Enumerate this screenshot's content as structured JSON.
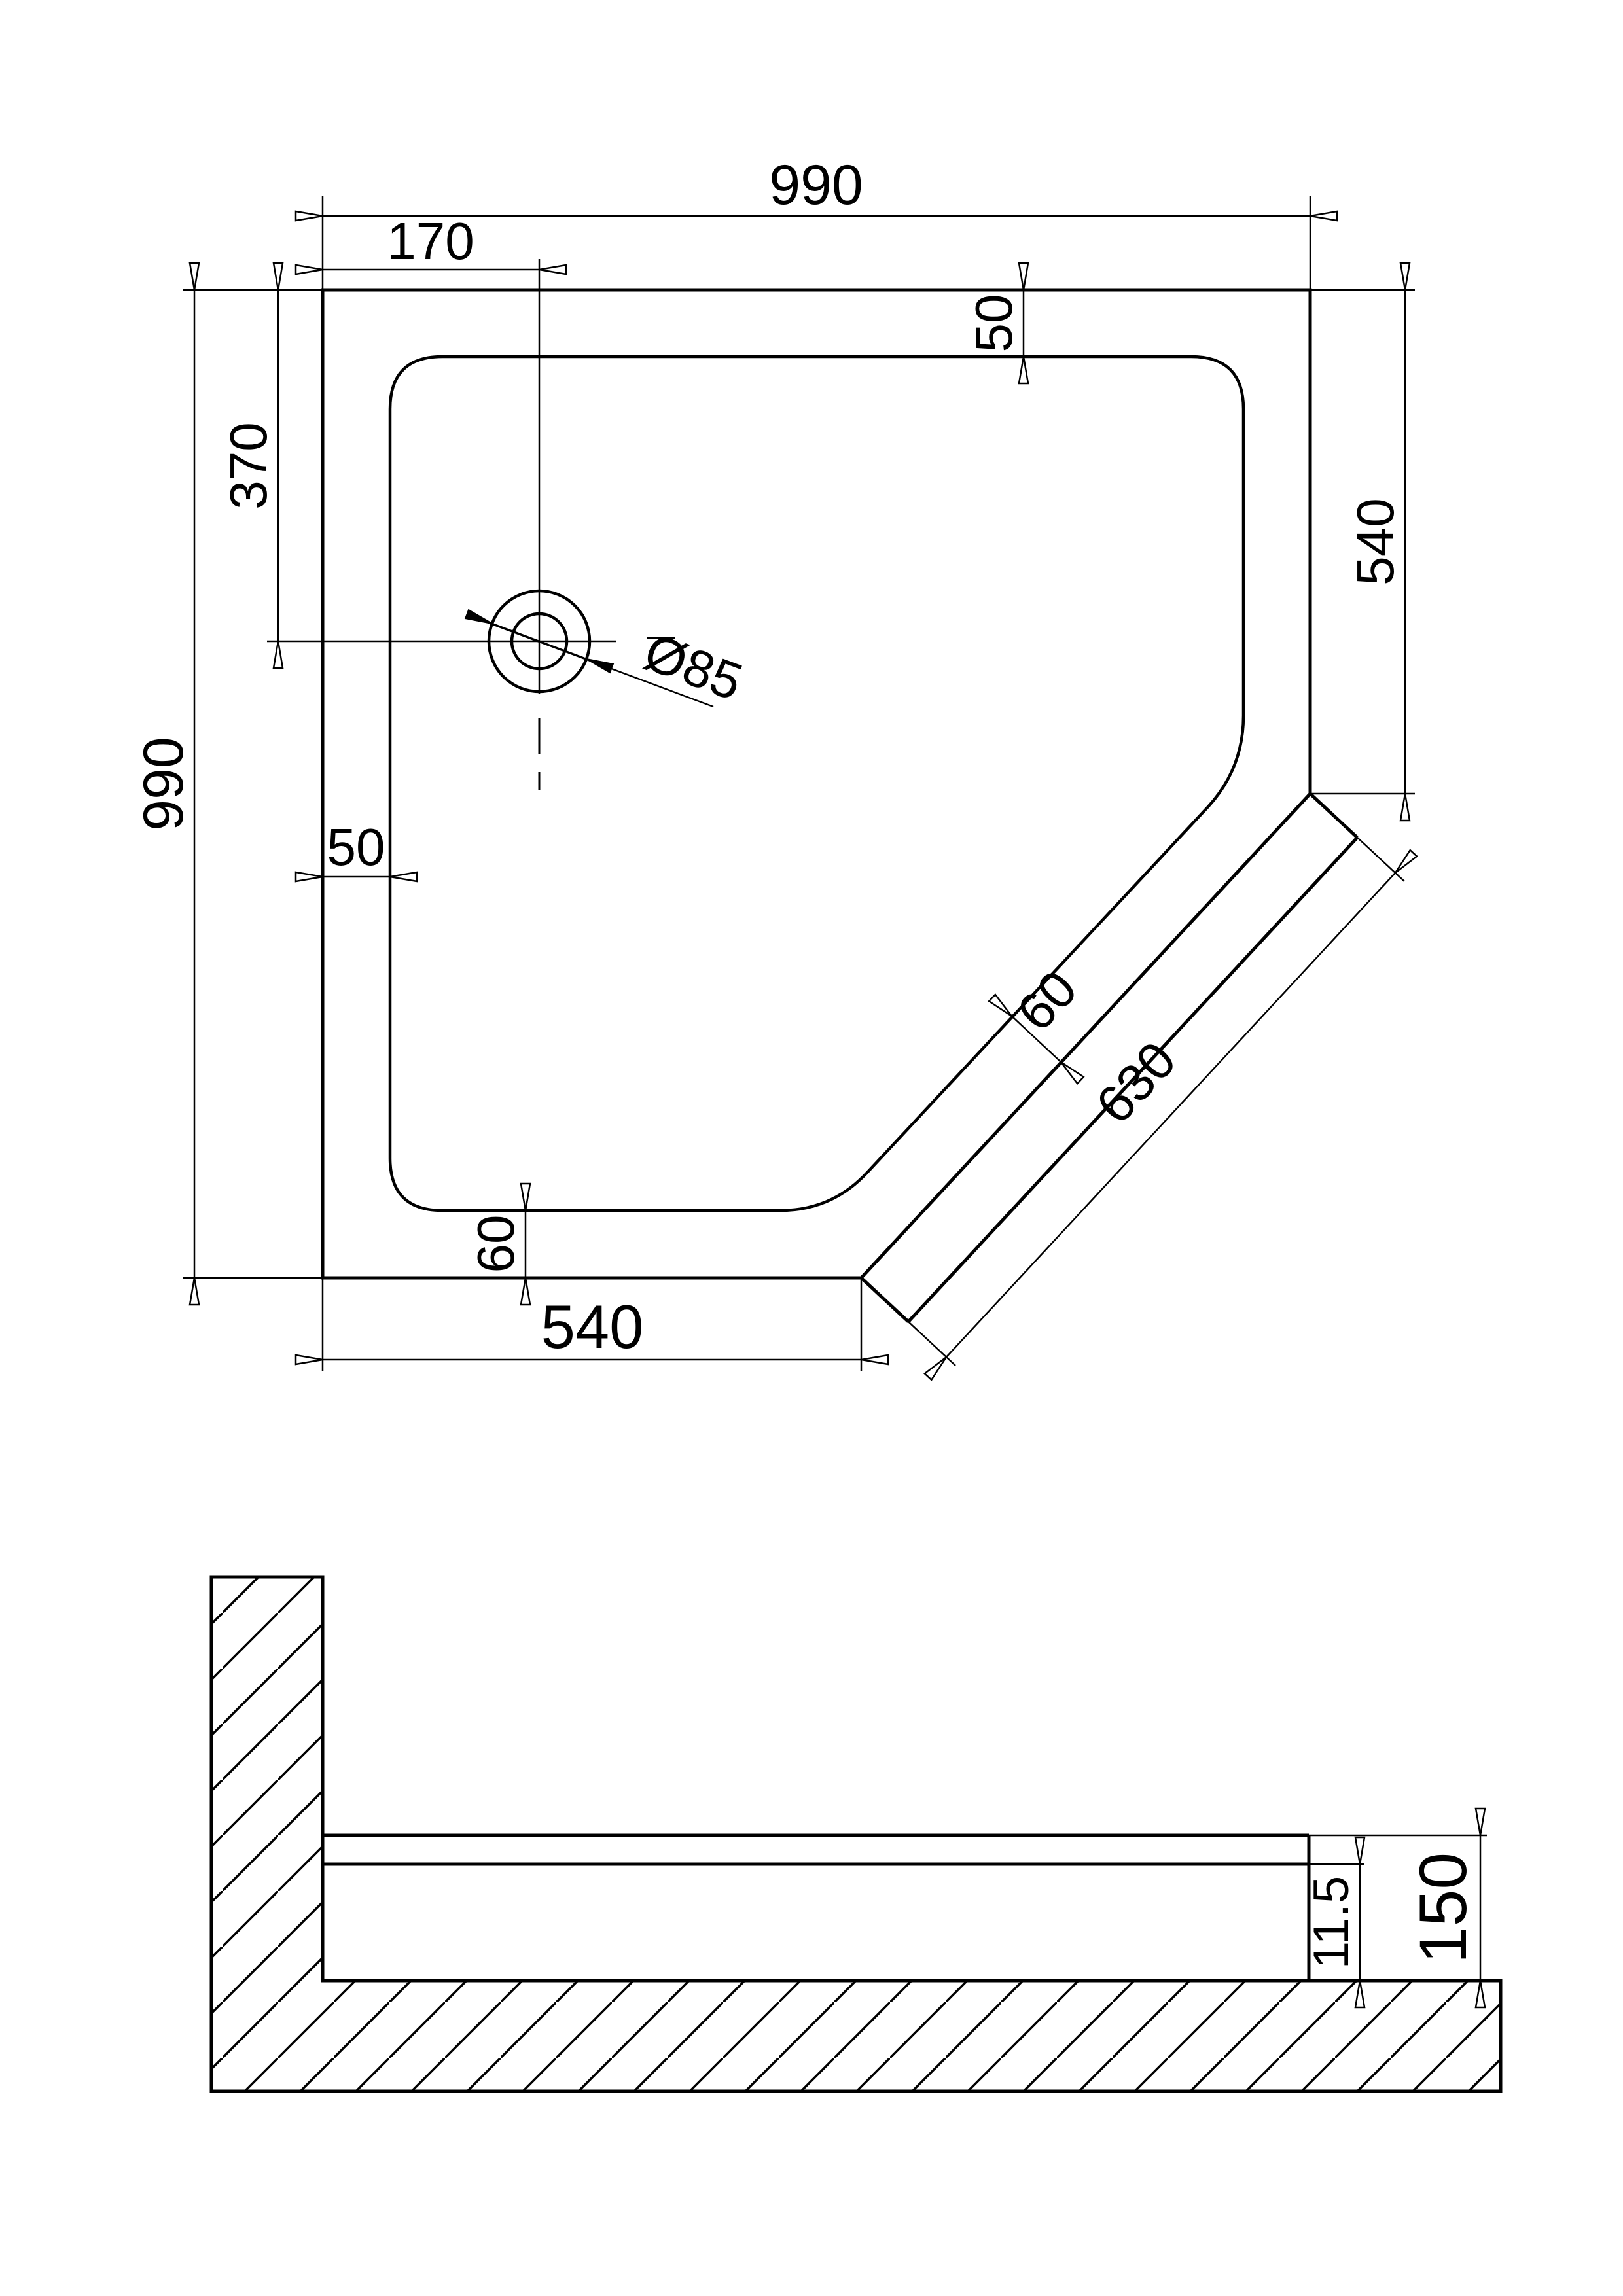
{
  "title": "Corner shower tray technical drawing",
  "colors": {
    "background": "#ffffff",
    "line": "#000000"
  },
  "top_view": {
    "dim_top_width": "990",
    "dim_drain_offset_x": "170",
    "dim_rim_top": "50",
    "dim_right_edge": "540",
    "dim_overall_height": "990",
    "dim_drain_offset_y": "370",
    "dim_drain_diameter": "Ø85",
    "dim_rim_left": "50",
    "dim_rim_chamfer": "60",
    "dim_chamfer_length": "630",
    "dim_rim_bottom": "60",
    "dim_bottom_edge": "540"
  },
  "section_view": {
    "dim_inner_depth": "11.5",
    "dim_overall_height": "150"
  }
}
